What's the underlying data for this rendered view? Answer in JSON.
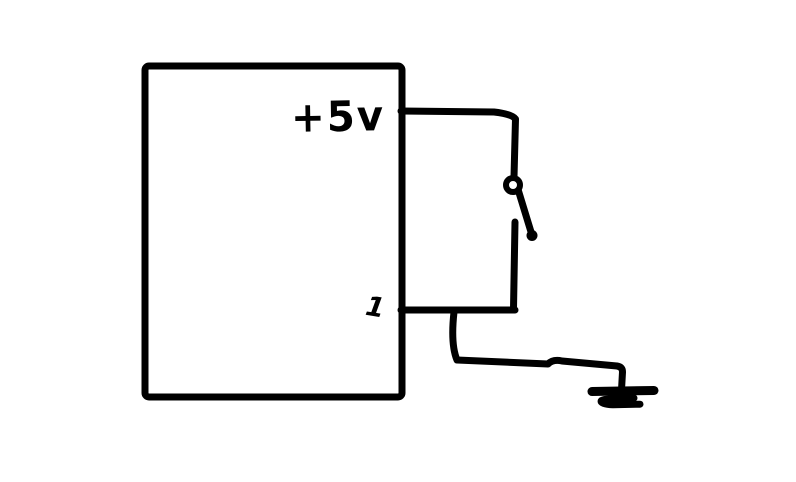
{
  "diagram": {
    "background_color": "#ffffff",
    "ink_color": "#000000",
    "labels": {
      "supply_voltage": "+5v",
      "pin_number": "1"
    },
    "components": {
      "box": "module-box",
      "switch": "open-switch",
      "ground": "ground-symbol"
    }
  }
}
